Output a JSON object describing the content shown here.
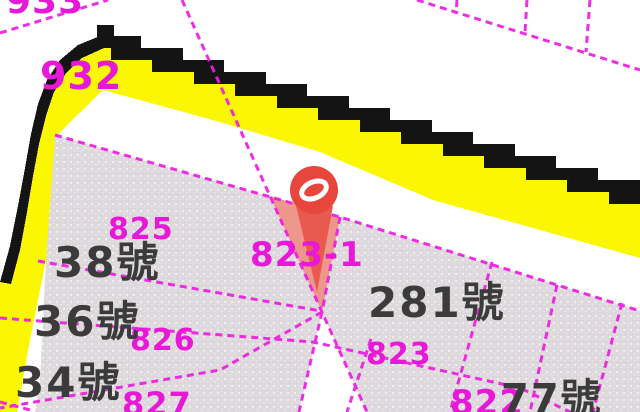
{
  "map": {
    "type_label": "cadastral-parcel-map",
    "parcel_labels": {
      "p933": "933",
      "p932": "932",
      "p825": "825",
      "p826": "826",
      "p827": "827",
      "p823": "823",
      "p823_1": "823-1",
      "p822": "822"
    },
    "house_numbers": {
      "h38": "38號",
      "h36": "36號",
      "h34": "34號",
      "h281": "281號",
      "h77": "77號"
    },
    "icons": {
      "pin": "location-pin-icon",
      "pin_glyph": "spiral-ring-icon"
    },
    "colors": {
      "road_yellow": "#fbf700",
      "road_border_black": "#141414",
      "boundary_magenta": "#ee1ce2",
      "parcel_gray": "#ded9dc",
      "house_text_gray": "#3b3b3b",
      "parcel_text_magenta": "#e718d8",
      "pin_red": "#e8463d",
      "highlight_salmon": "#f0897e",
      "background_white": "#ffffff"
    }
  }
}
